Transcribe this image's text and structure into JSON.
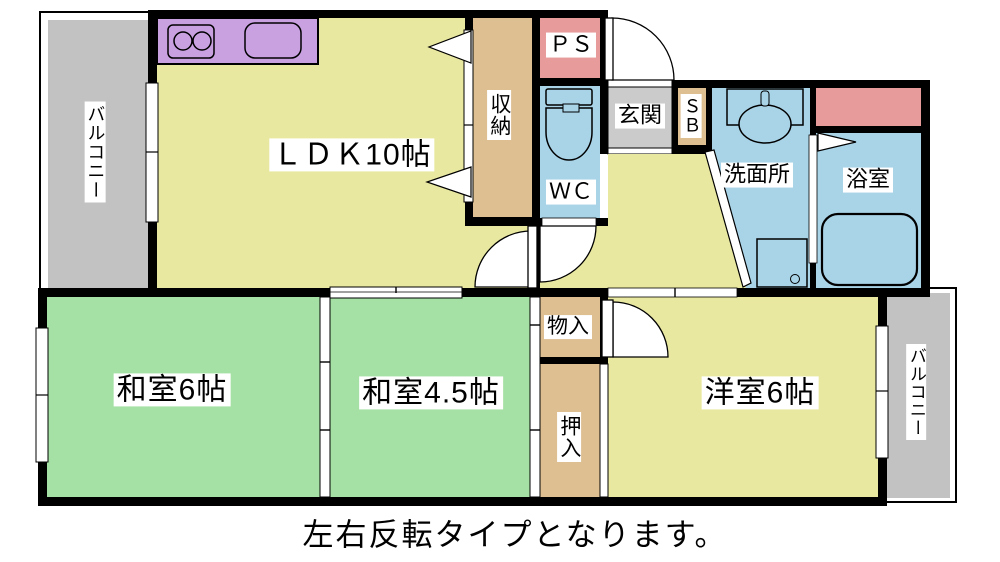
{
  "plan": {
    "labels": {
      "balcony_left": "バルコニー",
      "ldk": "ＬＤＫ10帖",
      "storage": "収納",
      "pipe_space": "ＰＳ",
      "toilet": "ＷＣ",
      "entrance": "玄関",
      "shoe_box": "ＳＢ",
      "washroom": "洗面所",
      "bathroom": "浴室",
      "japanese_room_6": "和室6帖",
      "japanese_room_4_5": "和室4.5帖",
      "storage_small": "物入",
      "futon_closet": "押入",
      "western_room_6": "洋室6帖",
      "balcony_right": "バルコニー"
    },
    "caption": "左右反転タイプとなります。",
    "colors": {
      "room_yellow": "#e9e8a0",
      "tatami_green": "#a5e0a4",
      "water_blue": "#a9d4e8",
      "closet_tan": "#ddbf92",
      "pipe_pink": "#e89b9b",
      "kitchen_purple": "#c9a1e1",
      "balcony_gray": "#c2c2c2",
      "entrance_gray": "#cbcbcb",
      "wall_black": "#000000"
    }
  }
}
